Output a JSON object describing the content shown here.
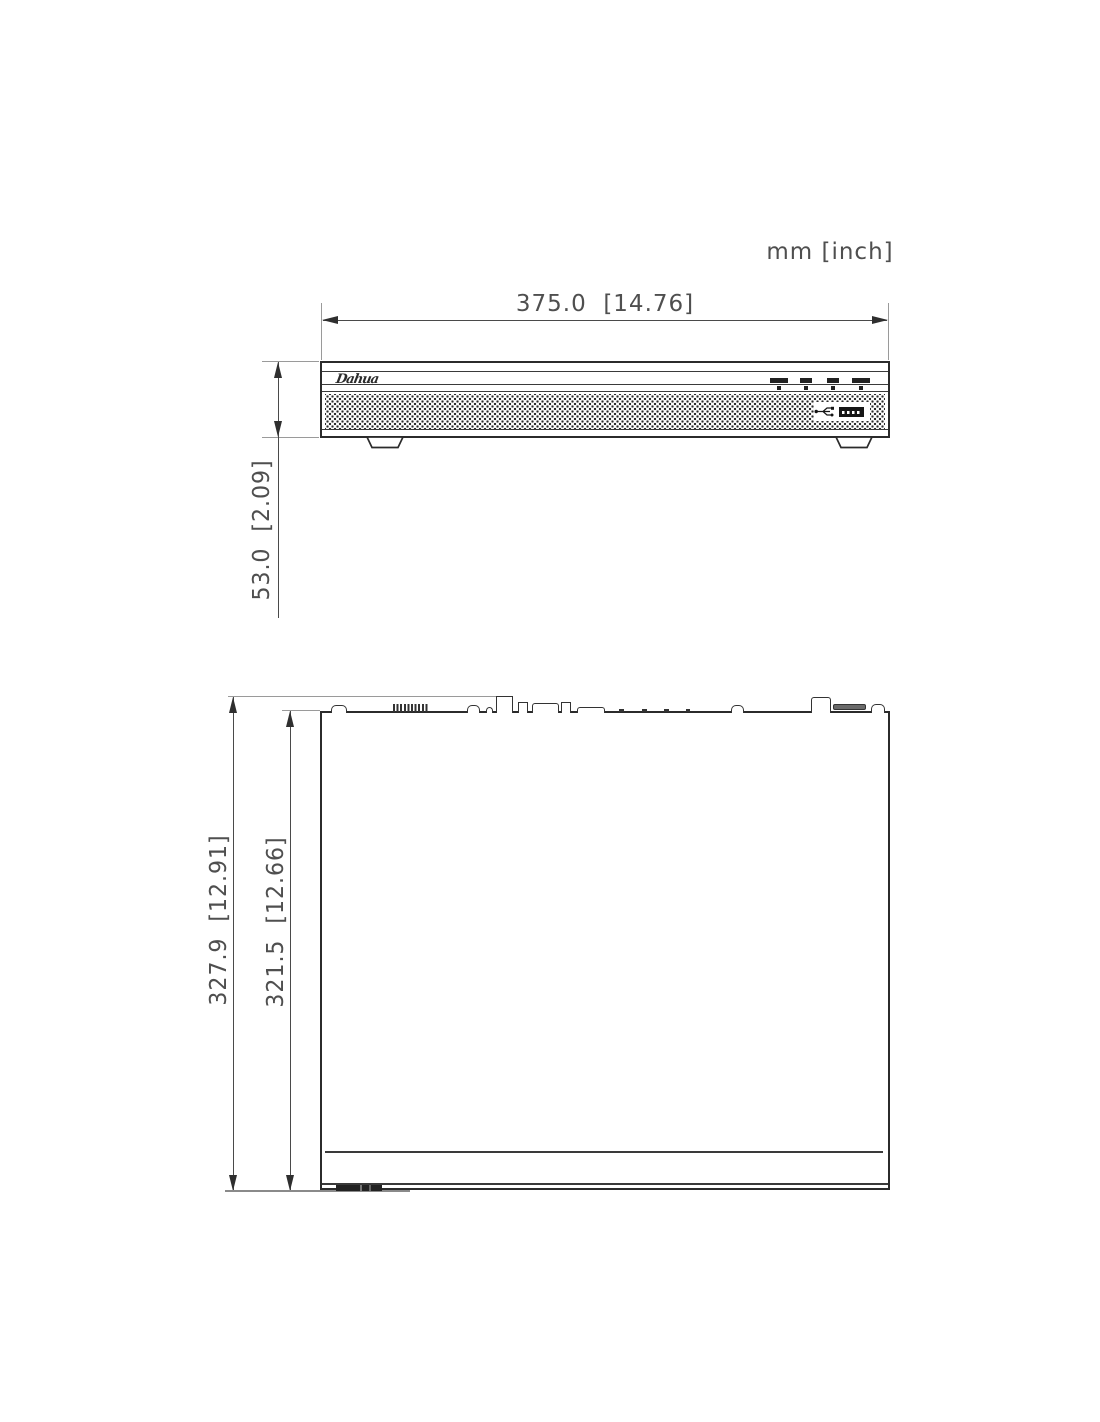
{
  "units_note": "mm [inch]",
  "front_view": {
    "width_label": "375.0  [14.76]",
    "height_label": "53.0  [2.09]",
    "logo_text": "Dahua",
    "indicators": [
      "status-led-1",
      "status-led-2",
      "status-led-3",
      "status-led-4"
    ],
    "icons": [
      "usb-icon",
      "usb-port-icon",
      "mesh-grille-icon",
      "foot-left-icon",
      "foot-right-icon"
    ]
  },
  "top_view": {
    "outer_depth_label": "327.9  [12.91]",
    "inner_depth_label": "321.5  [12.66]",
    "rear_connectors": [
      "screw-bump",
      "terminal-block",
      "screw-bump",
      "pin-bump",
      "power-socket",
      "pin-connector",
      "vga-connector",
      "pin-connector",
      "low-bump",
      "tick-marks",
      "screw-bump",
      "power-inlet",
      "vent-bar",
      "screw-bump"
    ]
  },
  "colors": {
    "outline": "#2b2b2b",
    "dimension_line": "#4a4a4a",
    "dimension_text": "#4f4f4f",
    "extension_line": "#9a9a9a",
    "background": "#ffffff"
  }
}
